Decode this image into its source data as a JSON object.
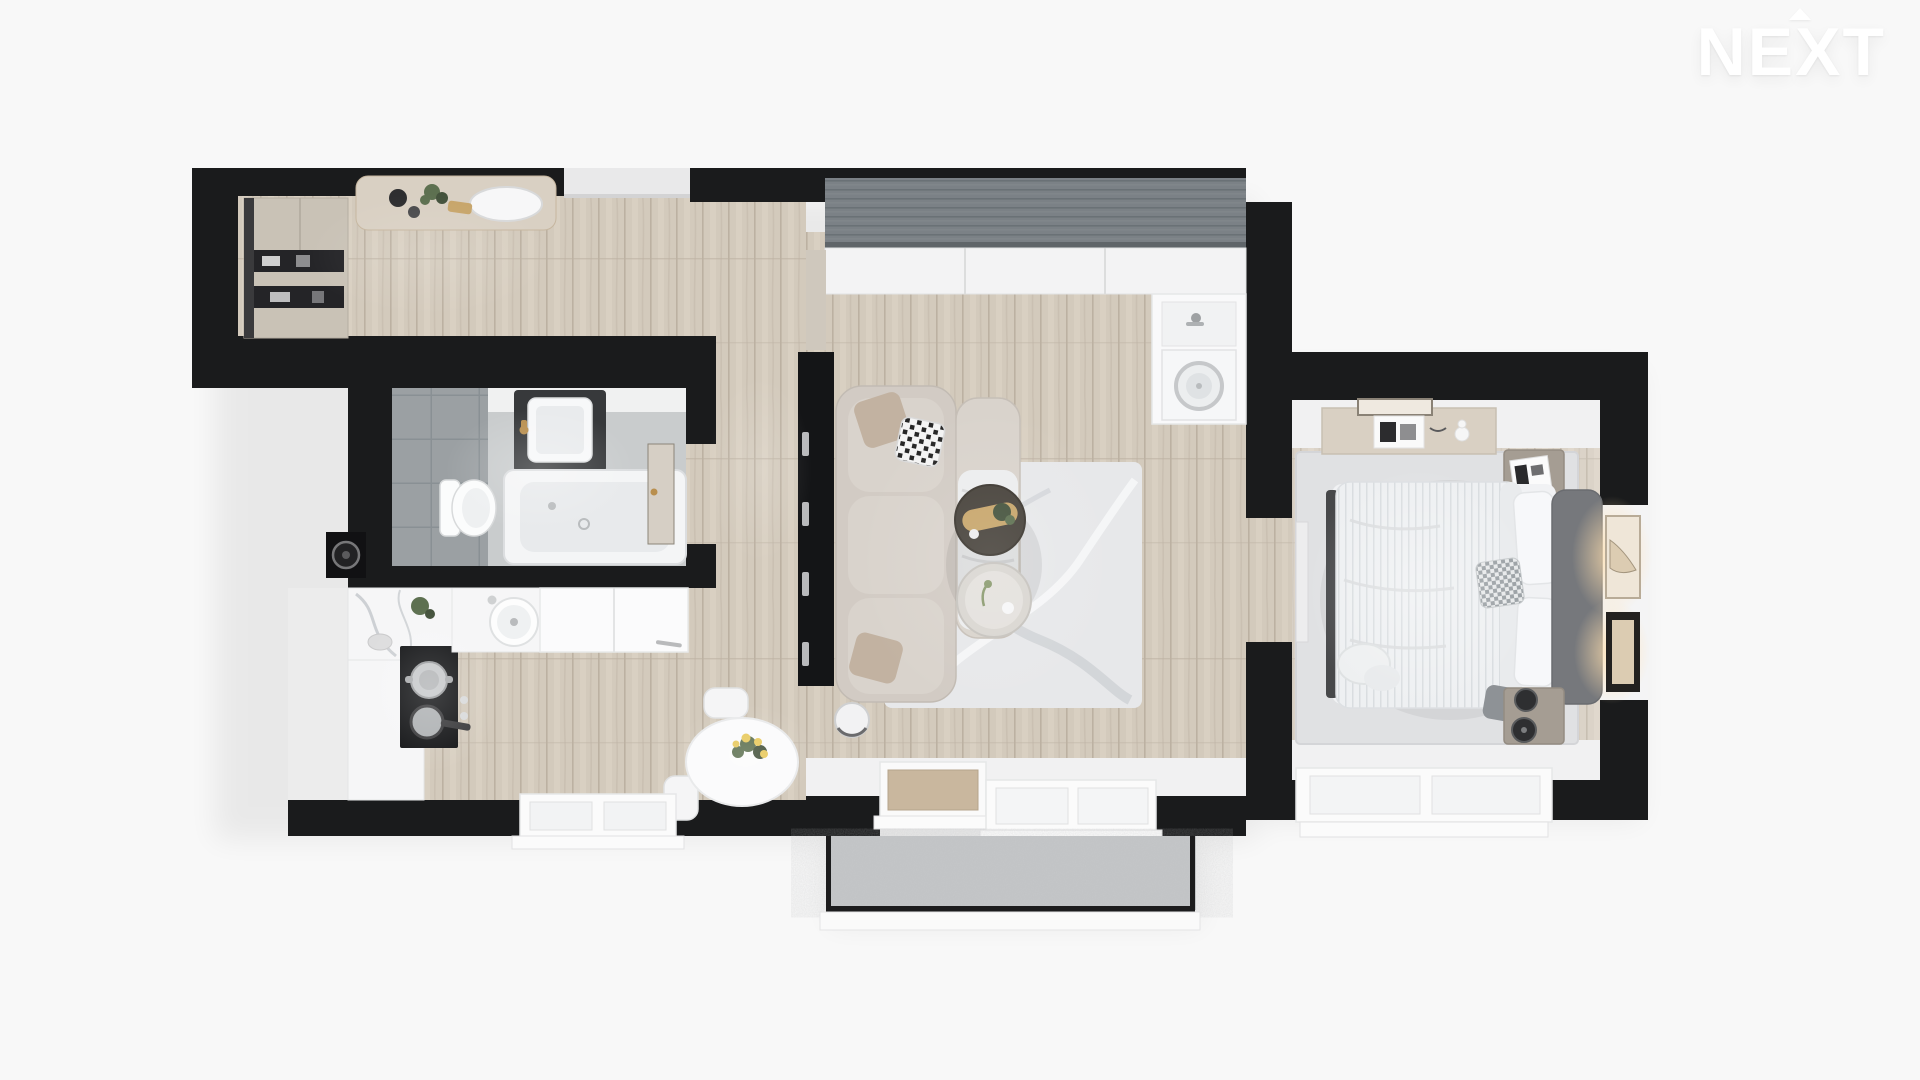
{
  "page": {
    "background": "#f8f8f8",
    "description": "3D top-down architectural render of a one-bedroom apartment with balcony"
  },
  "logo": {
    "text": "NEXT",
    "roof_accent": "small roof caret above the letter E",
    "color": "#ffffff"
  },
  "colors": {
    "bg": "#f8f8f8",
    "logo": "#ffffff",
    "wall": "#1a1b1c",
    "outer_light": "#ececec",
    "inner_wall": "#f1f1f2",
    "wood_base": "#d3cabc",
    "wood_seam": "#bcb1a2",
    "wood_light": "#ddd5c7",
    "wood_grain": "#c6bcae",
    "tile_wall": "#9ba0a3",
    "tile_seam": "#899094",
    "tile_floor": "#c9cccd",
    "white_surface": "#f6f6f7",
    "white_edge": "#dfe1e2",
    "greige": "#c9c2b6",
    "greige_edge": "#b3ac9f",
    "shelf_dark": "#242427",
    "slat": "#7b8186",
    "slat_line": "#686e73",
    "cabinet": "#f3f3f4",
    "appliance": "#141517",
    "steel": "#c6c8ca",
    "sofa": "#d2cbc4",
    "sofa_edge": "#bfb8b0",
    "cushion": "#d9d3cc",
    "pillow_taupe": "#c2b2a1",
    "rug_living": "#e7e8ea",
    "rug_vein": "#ced1d5",
    "table_dark": "#46413a",
    "gold": "#c7a56a",
    "table_light": "#d9d6d1",
    "concrete": "#c5c7c9",
    "railing": "#1c1c1d",
    "rug_bed": "#e0e1e3",
    "duvet": "#eef0f2",
    "duvet_line": "#d9dde0",
    "headboard": "#76787c",
    "bench": "#47484a",
    "nightstand": "#a59d93",
    "dresser": "#d9d0c3",
    "lamp": "#2e2f31",
    "art_dark": "#23211f",
    "art_beige": "#dcccb2",
    "glow_warm": "#ffdfae",
    "plant": "#5d7050",
    "plant_dark": "#44523c",
    "flower": "#e8c95c",
    "brass": "#b98f4e",
    "door_wood": "#c9b79e",
    "marble_vein": "#c3c7cb"
  },
  "floor_plan": {
    "rooms": [
      {
        "name": "entry-hall",
        "furniture": [
          "greige-wardrobe-with-open-shelves",
          "wood-console-table",
          "decor-plant",
          "oval-tray",
          "entrance-door-recess"
        ]
      },
      {
        "name": "bathroom",
        "furniture": [
          "bathtub",
          "wall-hung-toilet",
          "dark-vanity-with-white-sink",
          "brass-faucet",
          "grey-wall-tiles",
          "open-door-leaf",
          "corner-washer-niche"
        ]
      },
      {
        "name": "kitchen",
        "furniture": [
          "marble-counter",
          "white-l-counter",
          "black-cooktop",
          "steel-pot",
          "frying-pan",
          "round-sink",
          "fridge-cabinet-block",
          "dining-table",
          "flower-bouquet",
          "two-chairs",
          "window"
        ]
      },
      {
        "name": "living-room",
        "furniture": [
          "grey-slat-closet-panel",
          "white-cabinet-row",
          "utility-niche-with-washer",
          "dark-storage-wall",
          "l-shaped-sectional-sofa",
          "throw-pillows",
          "chaise-blanket",
          "dark-round-coffee-table",
          "gold-tray",
          "light-round-side-table",
          "area-rug",
          "round-pouf",
          "balcony-door",
          "double-window"
        ]
      },
      {
        "name": "bedroom",
        "furniture": [
          "double-bed",
          "striped-duvet",
          "upholstered-headboard",
          "pillows",
          "checked-cushion",
          "nightstand-top",
          "nightstand-bottom",
          "black-table-lamps",
          "dresser-with-decor",
          "book",
          "area-rug",
          "wall-art-with-warm-lights",
          "window",
          "open-door"
        ]
      },
      {
        "name": "balcony",
        "furniture": [
          "concrete-floor",
          "glass-railing-frame",
          "white-outer-ledge"
        ]
      }
    ]
  }
}
